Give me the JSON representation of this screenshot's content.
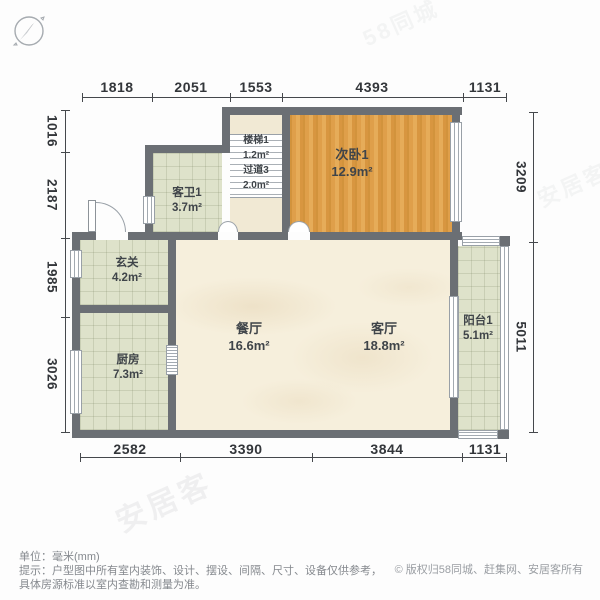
{
  "compass": {
    "needle_direction": "NE"
  },
  "dimensions": {
    "top": [
      "1818",
      "2051",
      "1553",
      "4393",
      "1131"
    ],
    "bottom": [
      "2582",
      "3390",
      "3844",
      "1131"
    ],
    "left": [
      "1016",
      "2187",
      "1985",
      "3026"
    ],
    "right": [
      "3209",
      "5011"
    ]
  },
  "rooms": {
    "bedroom2": {
      "name": "次卧1",
      "area": "12.9m²"
    },
    "bathroom": {
      "name": "客卫1",
      "area": "3.7m²"
    },
    "stairs": {
      "name": "楼梯1",
      "area": "1.2m²"
    },
    "corridor": {
      "name": "过道3",
      "area": "2.0m²"
    },
    "foyer": {
      "name": "玄关",
      "area": "4.2m²"
    },
    "kitchen": {
      "name": "厨房",
      "area": "7.3m²"
    },
    "dining": {
      "name": "餐厅",
      "area": "16.6m²"
    },
    "living": {
      "name": "客厅",
      "area": "18.8m²"
    },
    "balcony": {
      "name": "阳台1",
      "area": "5.1m²"
    }
  },
  "footer": {
    "unit_line": "单位：毫米(mm)",
    "tip_line1": "提示：户型图中所有室内装饰、设计、摆设、间隔、尺寸、设备仅供参考，",
    "tip_line2": "具体房源标准以室内查勘和测量为准。",
    "copyright_symbol": "©",
    "copyright_text": "版权归58同城、赶集网、安居客所有"
  },
  "watermarks": {
    "brand": "安居客",
    "brand_alt": "58同城"
  },
  "colors": {
    "wall": "#6b6f74",
    "wood": "#dfa04c",
    "tile": "#dee2ca",
    "marble": "#f6efdc",
    "text": "#3f4449"
  }
}
